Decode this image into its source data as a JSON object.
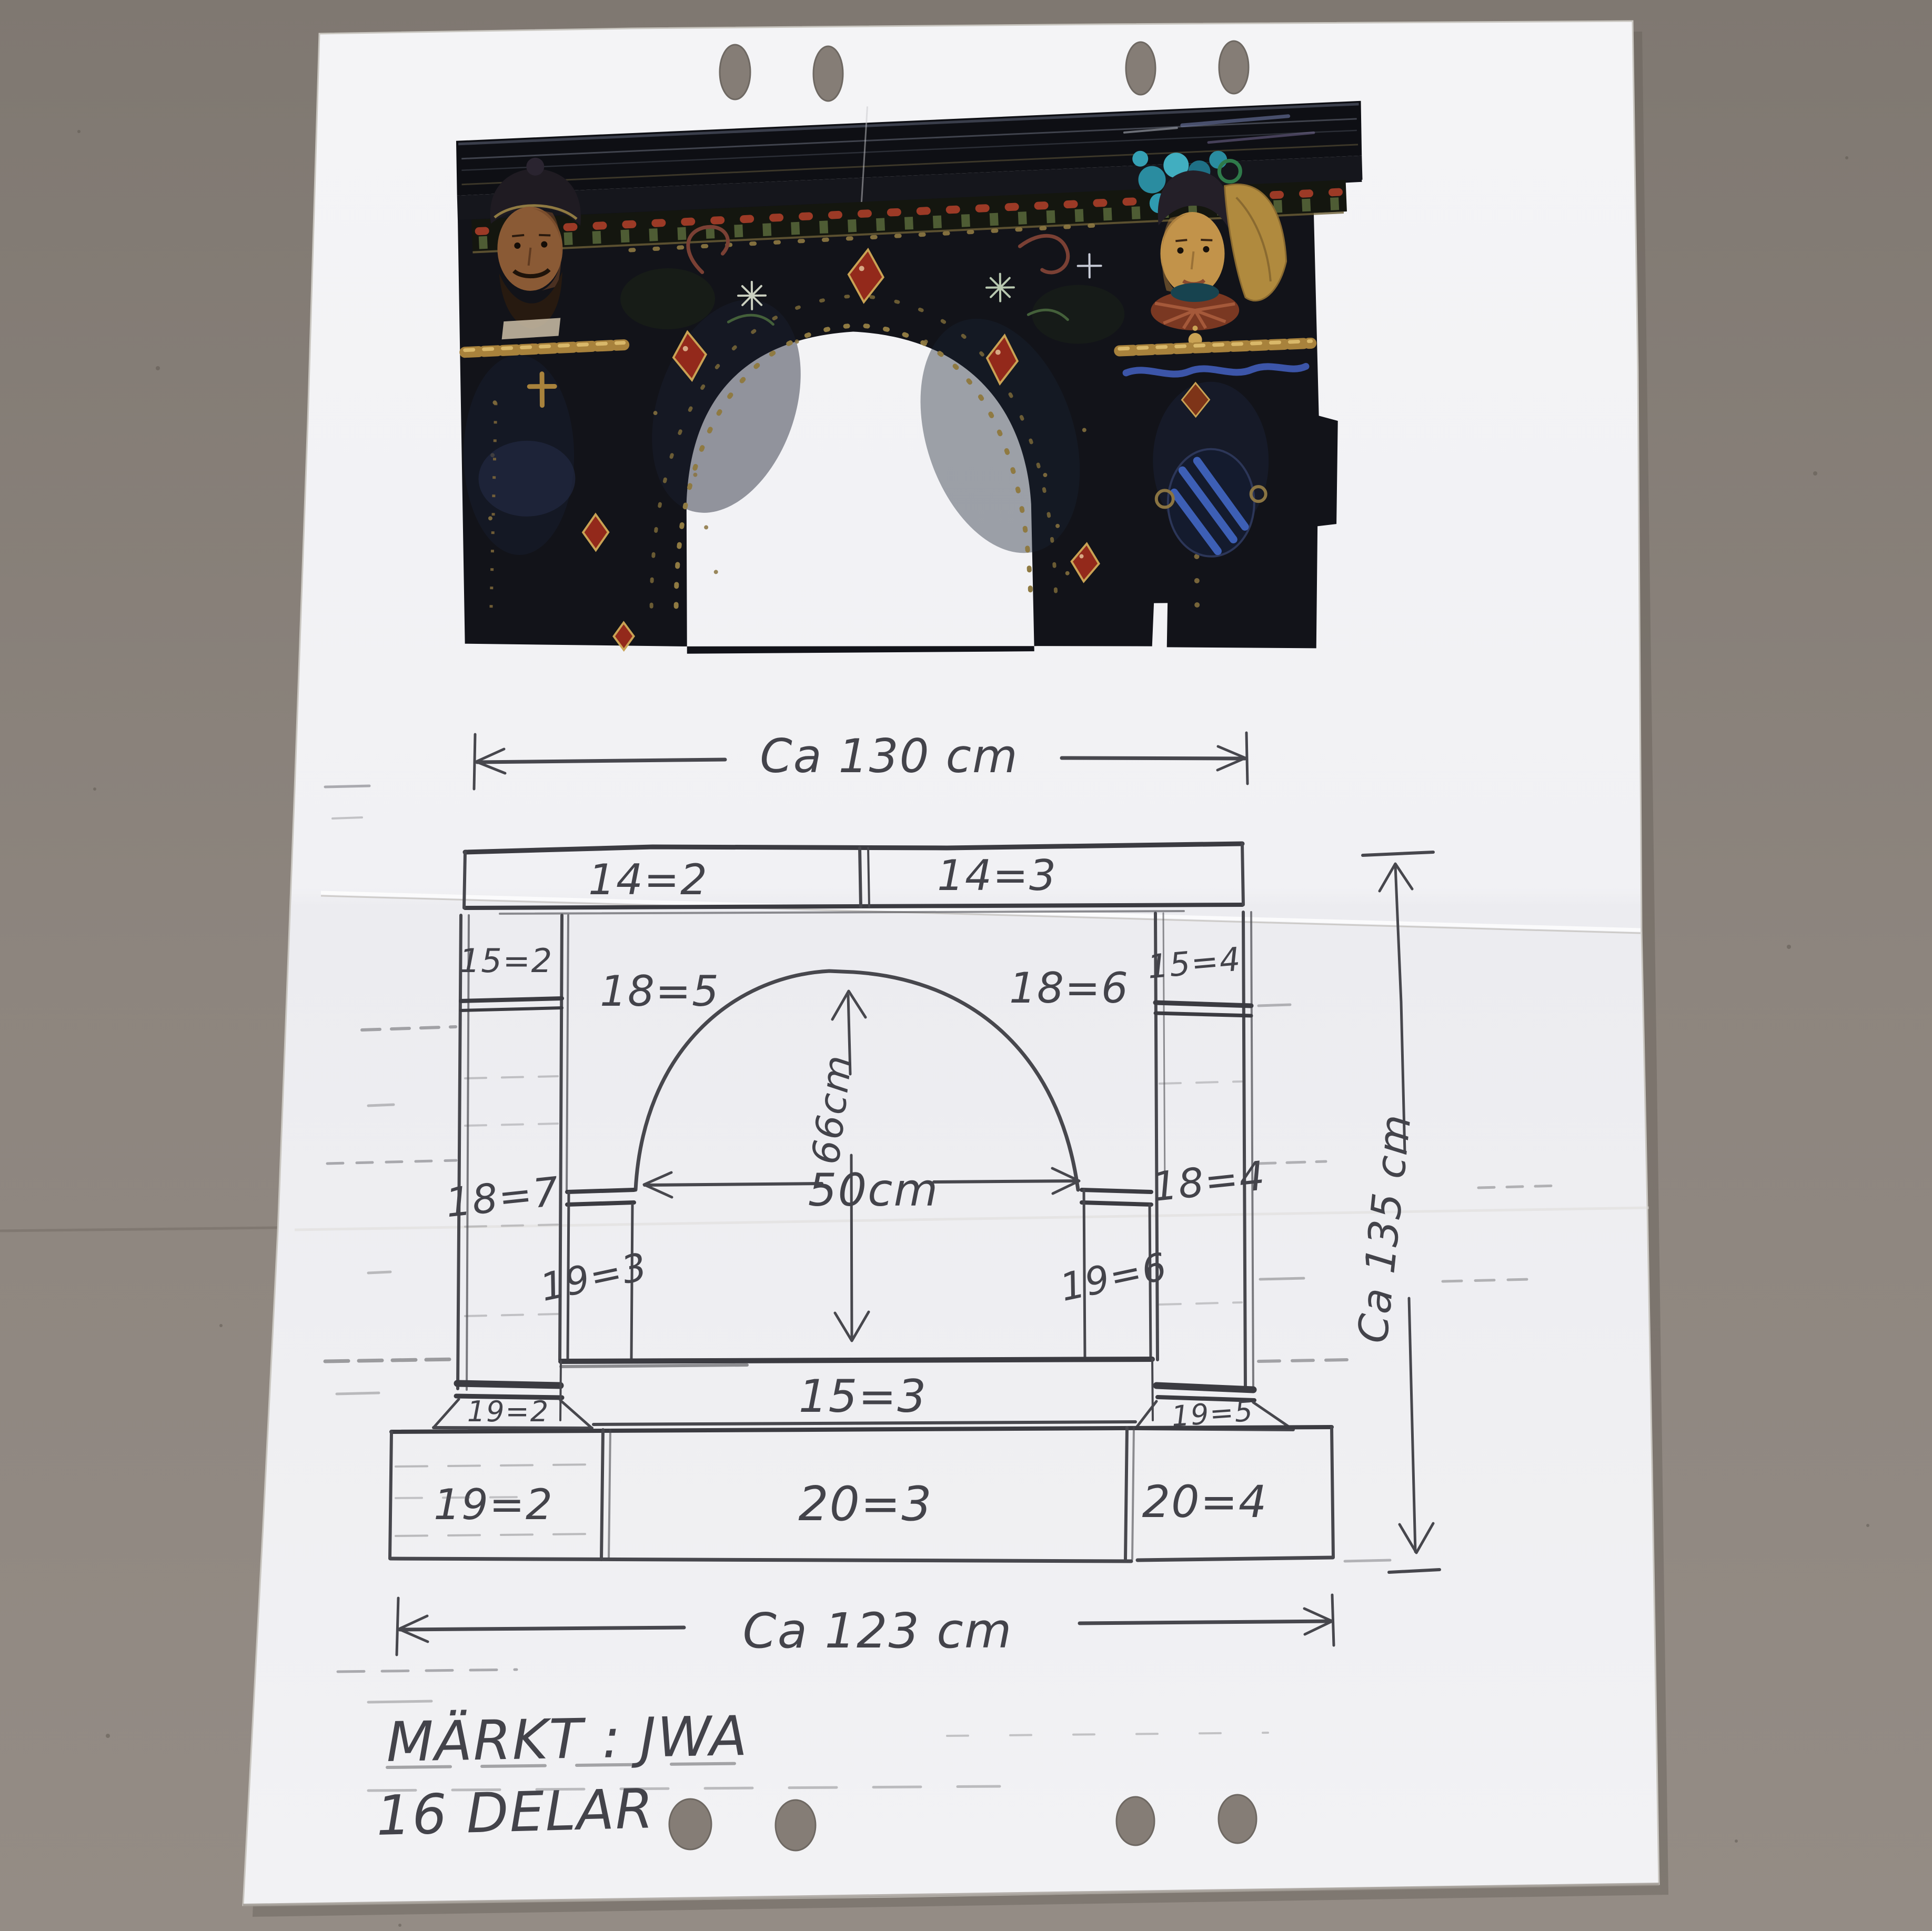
{
  "scene": {
    "background_color": "#8a827b",
    "paper_color": "#f3f3f5",
    "ink_color": "#47474d"
  },
  "photo": {
    "description": "Color photograph of a dark glazed ceramic fireplace surround with arched opening, two caryatid figures, red gem diamonds and gold rope details",
    "colors": {
      "body": "#121319",
      "gem_red": "#93291b",
      "gold": "#c9a254",
      "teal": "#3aa8ba",
      "face_left": "#8a5a35",
      "face_right": "#c2934a"
    }
  },
  "diagram": {
    "dimensions": {
      "top": "Ca 130 cm",
      "bottom": "Ca 123 cm",
      "right": "Ca 135 cm",
      "arch_height": "66cm",
      "arch_width": "50cm"
    },
    "labels": {
      "cornice_left": "14=2",
      "cornice_right": "14=3",
      "cap_left": "15=2",
      "cap_right": "15=4",
      "spandrel_left": "18=5",
      "spandrel_right": "18=6",
      "pilaster_left": "18=7",
      "pilaster_right": "18=4",
      "inner_left": "19=3",
      "inner_right": "19=6",
      "lintel": "15=3",
      "plinth_left": "19=2",
      "plinth_right": "19=5",
      "base_left": "19=2",
      "base_center": "20=3",
      "base_right": "20=4"
    }
  },
  "notes": {
    "line1": "MÄRKT : JWA",
    "line2": "16 DELAR"
  }
}
